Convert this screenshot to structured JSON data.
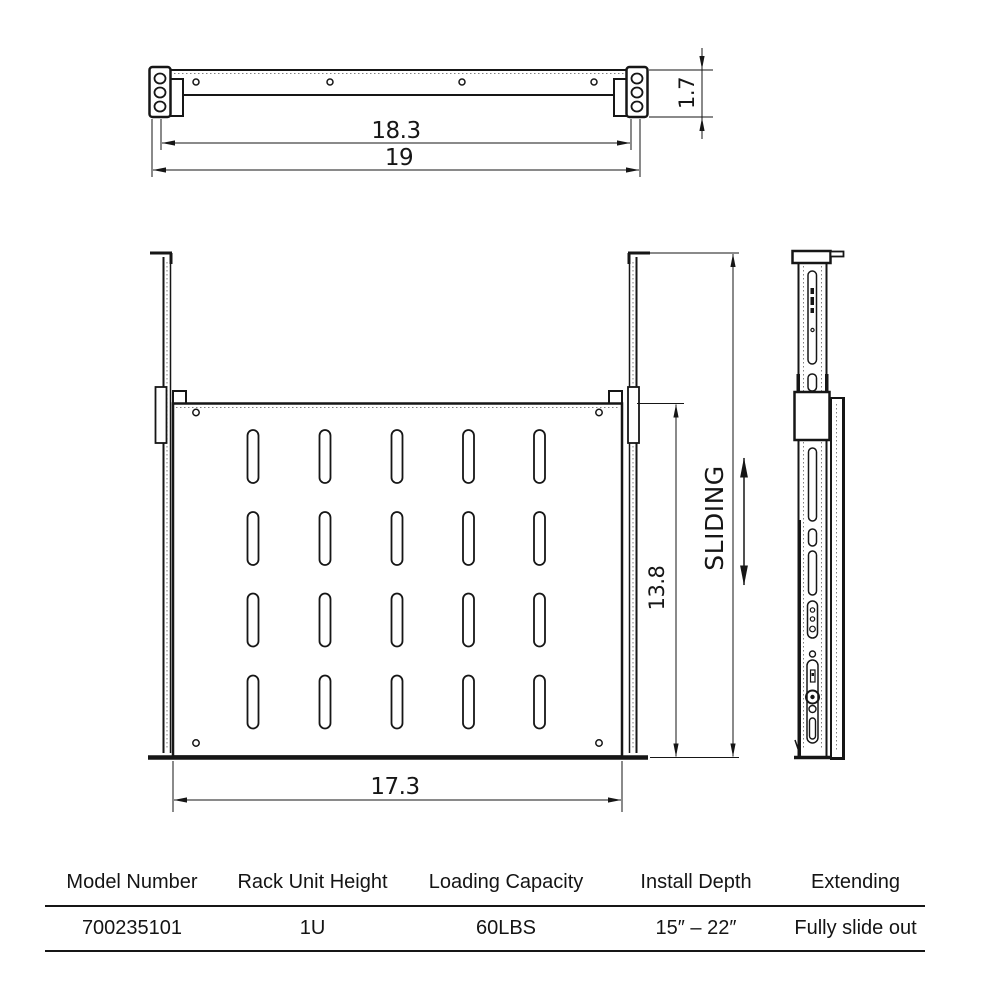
{
  "drawing": {
    "title": "rack-shelf-technical-drawing",
    "colors": {
      "line": "#161616",
      "background": "#ffffff",
      "dotted": "#808080"
    },
    "dimensions": {
      "mount_width_inner": "18.3",
      "mount_width_outer": "19",
      "bracket_height": "1.7",
      "shelf_depth": "13.8",
      "shelf_width": "17.3"
    },
    "labels": {
      "sliding": "SLIDING"
    }
  },
  "spec_table": {
    "headers": [
      "Model Number",
      "Rack Unit Height",
      "Loading Capacity",
      "Install Depth",
      "Extending"
    ],
    "row": [
      "700235101",
      "1U",
      "60LBS",
      "15″ – 22″",
      "Fully slide out"
    ]
  }
}
